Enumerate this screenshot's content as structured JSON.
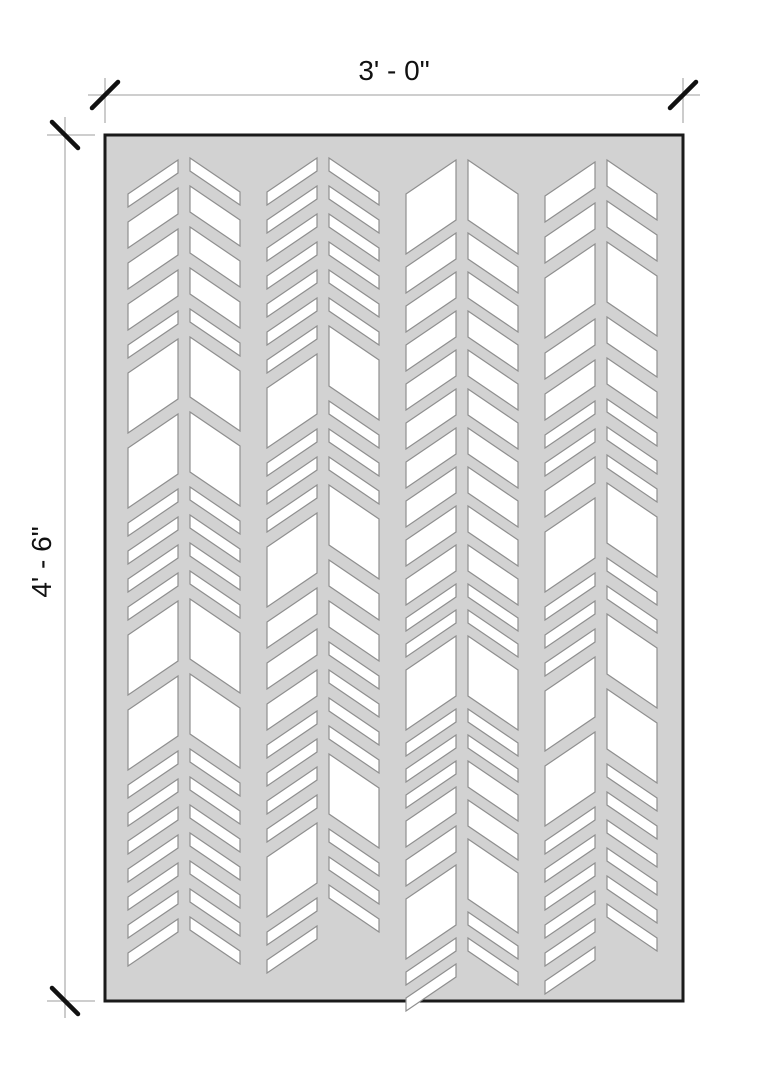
{
  "drawing": {
    "kind": "decorative chevron screen panel elevation",
    "background": "#ffffff"
  },
  "dimensions": {
    "width_label": "3' - 0\"",
    "height_label": "4' - 6\""
  },
  "colors": {
    "background": "#ffffff",
    "panel_fill": "#d2d2d2",
    "panel_border": "#1a1a1a",
    "cutout_fill": "#ffffff",
    "cutout_stroke": "#8f8f8f",
    "dim_line": "#b0b0b0",
    "tick": "#111111",
    "text": "#111111"
  },
  "panel": {
    "x": 105,
    "y": 135,
    "width": 578,
    "height": 866
  },
  "dim_top": {
    "line_y": 95,
    "line_x1": 88,
    "line_x2": 700,
    "ext_y1": 78,
    "ext_y2": 123,
    "tick_size": 13,
    "label_cx": 394,
    "label_cy": 71
  },
  "dim_left": {
    "line_x": 65,
    "line_y1": 117,
    "line_y2": 1018,
    "ext_x1": 47,
    "ext_x2": 95,
    "tick_size": 13,
    "label_cx": 42,
    "label_cy": 562
  },
  "pattern": {
    "half_width": 50,
    "rib": 12,
    "drop": 34,
    "sizes": {
      "t": 13,
      "m": 26,
      "B": 60
    },
    "columns": [
      {
        "x0": 128,
        "gap": 15,
        "left": {
          "start": 160,
          "seq": [
            "t",
            "m",
            "m",
            "m",
            "t",
            "B",
            "B",
            "t",
            "t",
            "t",
            "t",
            "B",
            "B",
            "t",
            "t",
            "t",
            "t",
            "t",
            "t",
            "t"
          ]
        },
        "right": {
          "start": 158,
          "seq": [
            "t",
            "m",
            "m",
            "m",
            "t",
            "B",
            "B",
            "t",
            "t",
            "t",
            "t",
            "B",
            "B",
            "t",
            "t",
            "t",
            "t",
            "t",
            "t",
            "t"
          ]
        }
      },
      {
        "x0": 267,
        "gap": 15,
        "left": {
          "start": 158,
          "seq": [
            "t",
            "t",
            "t",
            "t",
            "t",
            "t",
            "t",
            "B",
            "t",
            "t",
            "t",
            "B",
            "m",
            "m",
            "m",
            "t",
            "t",
            "t",
            "t",
            "B",
            "t",
            "t"
          ]
        },
        "right": {
          "start": 158,
          "seq": [
            "t",
            "t",
            "t",
            "t",
            "t",
            "t",
            "B",
            "t",
            "t",
            "t",
            "B",
            "m",
            "m",
            "t",
            "t",
            "t",
            "t",
            "B",
            "t",
            "t",
            "t"
          ]
        }
      },
      {
        "x0": 406,
        "gap": 13,
        "left": {
          "start": 160,
          "seq": [
            "B",
            "m",
            "m",
            "m",
            "m",
            "m",
            "m",
            "m",
            "m",
            "m",
            "t",
            "t",
            "B",
            "t",
            "t",
            "t",
            "m",
            "m",
            "B",
            "t",
            "t"
          ]
        },
        "right": {
          "start": 160,
          "seq": [
            "B",
            "m",
            "m",
            "m",
            "m",
            "m",
            "m",
            "m",
            "m",
            "m",
            "t",
            "t",
            "B",
            "t",
            "t",
            "m",
            "m",
            "B",
            "t",
            "t"
          ]
        }
      },
      {
        "x0": 545,
        "gap": 15,
        "left": {
          "start": 162,
          "seq": [
            "m",
            "m",
            "B",
            "m",
            "m",
            "t",
            "t",
            "m",
            "B",
            "t",
            "t",
            "t",
            "B",
            "B",
            "t",
            "t",
            "t",
            "t",
            "t",
            "t"
          ]
        },
        "right": {
          "start": 160,
          "seq": [
            "m",
            "m",
            "B",
            "m",
            "m",
            "t",
            "t",
            "t",
            "B",
            "t",
            "t",
            "B",
            "B",
            "t",
            "t",
            "t",
            "t",
            "t",
            "t"
          ]
        }
      }
    ]
  }
}
